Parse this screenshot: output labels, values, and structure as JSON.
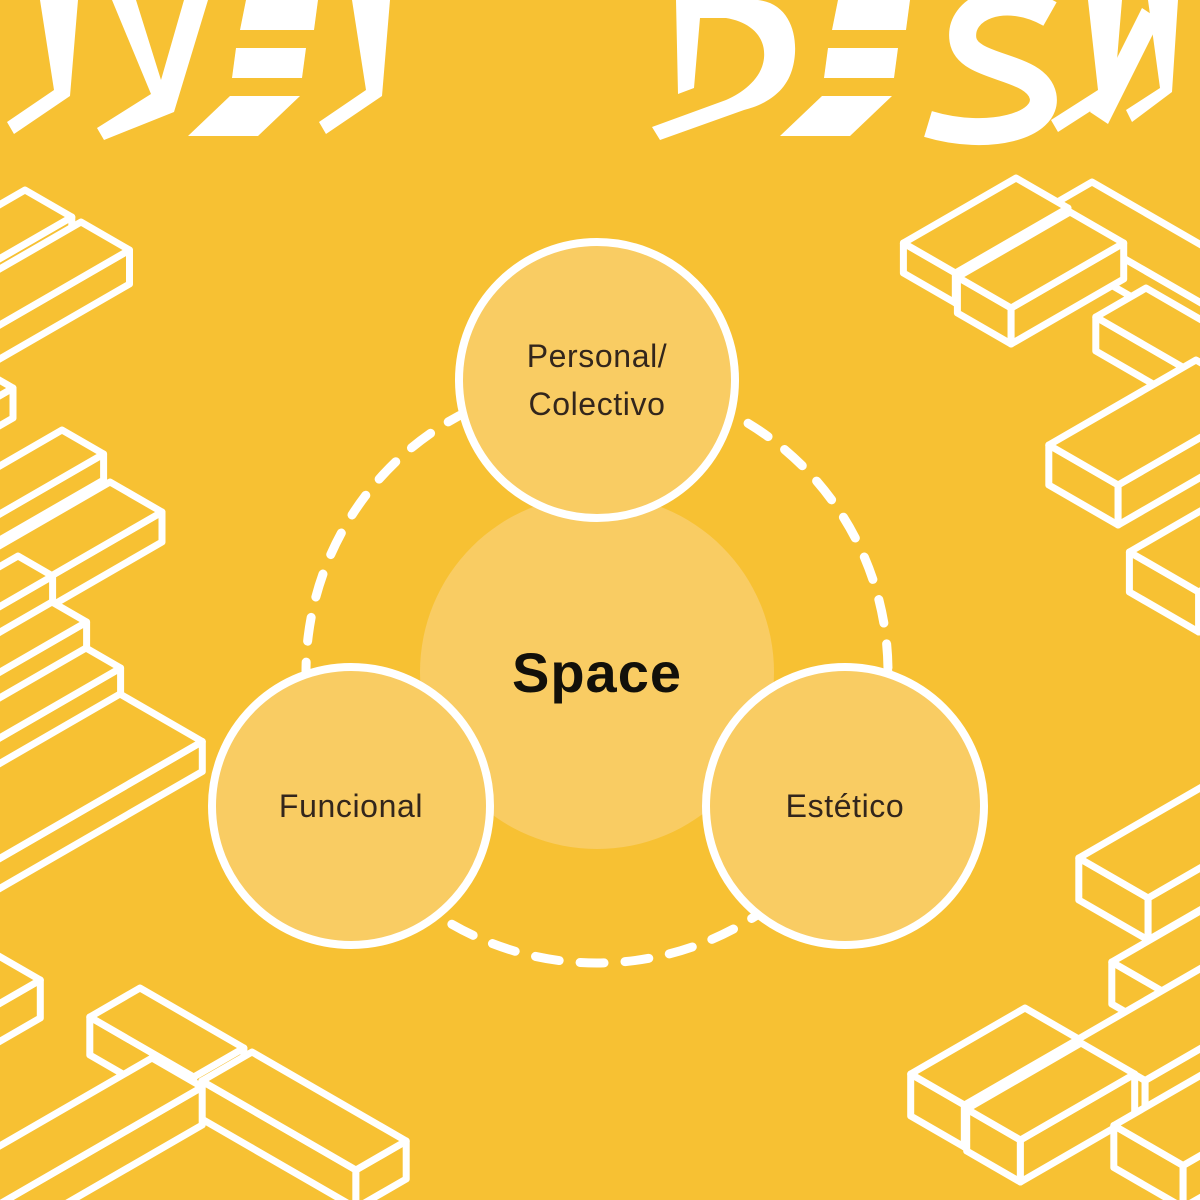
{
  "header": {
    "left_fragment": "IVEL",
    "right_fragment": "DESN",
    "full_text_visible": "IVEL DESN"
  },
  "diagram": {
    "center": {
      "label": "Space"
    },
    "nodes": [
      {
        "id": "personal-colectivo",
        "lines": [
          "Personal/",
          "Colectivo"
        ]
      },
      {
        "id": "funcional",
        "lines": [
          "Funcional"
        ]
      },
      {
        "id": "estetico",
        "lines": [
          "Estético"
        ]
      }
    ]
  },
  "colors": {
    "background": "#F7C133",
    "circle_fill": "#F9CC63",
    "outline_white": "#FFFFFF",
    "node_label_text": "#33261C",
    "center_label_text": "#12100A"
  }
}
